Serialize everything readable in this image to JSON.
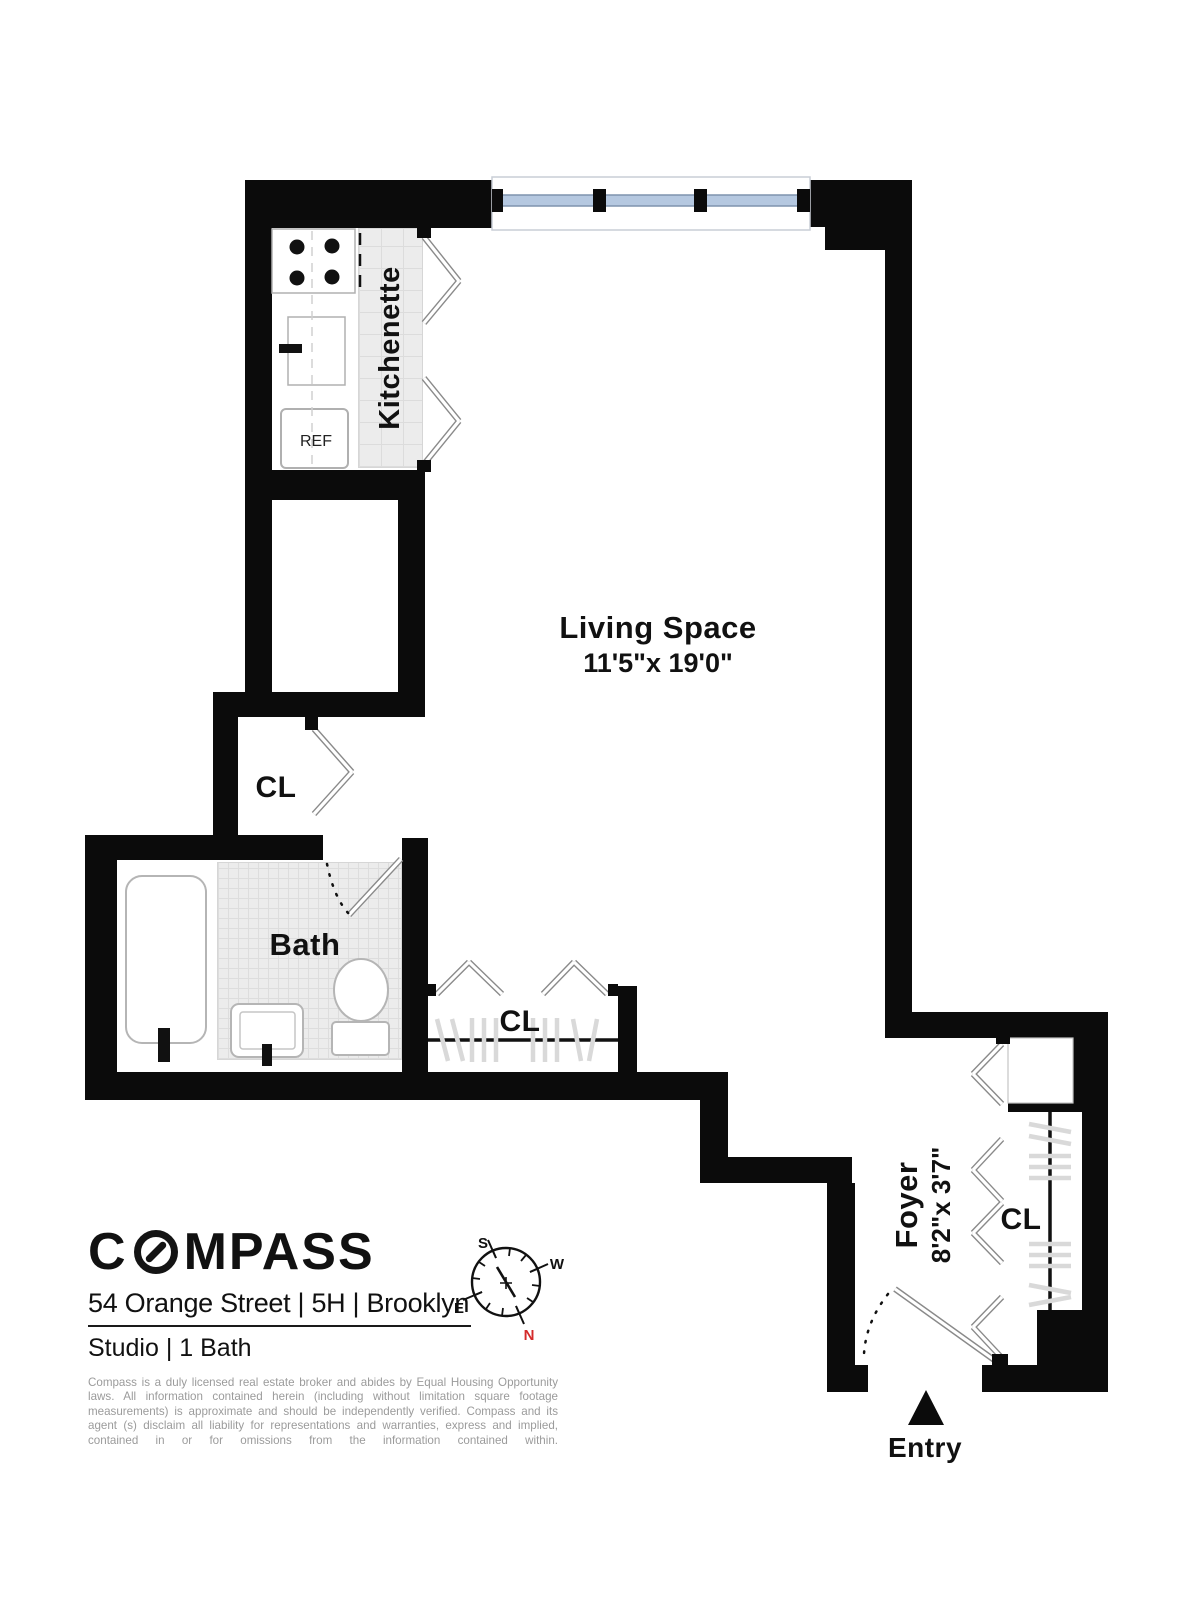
{
  "floorplan": {
    "rooms": {
      "kitchenette": {
        "label": "Kitchenette"
      },
      "living_space": {
        "label": "Living Space",
        "dimensions": "11'5\"x 19'0\""
      },
      "bath": {
        "label": "Bath"
      },
      "foyer": {
        "label": "Foyer",
        "dimensions": "8'2\"x 3'7\""
      },
      "closet_hall": {
        "label": "CL"
      },
      "closet_living": {
        "label": "CL"
      },
      "closet_foyer": {
        "label": "CL"
      },
      "entry": {
        "label": "Entry"
      },
      "refrigerator": {
        "label": "REF"
      }
    },
    "compass_rose": {
      "north": "N",
      "south": "S",
      "east": "E",
      "west": "W"
    }
  },
  "branding": {
    "logo": {
      "prefix": "C",
      "suffix": "MPASS"
    },
    "address": "54 Orange Street | 5H | Brooklyn",
    "unit_info": "Studio | 1 Bath",
    "disclaimer": "Compass is a duly licensed real estate broker and abides by Equal Housing Opportunity laws. All information contained herein (including without limitation square footage measurements) is approximate and should be independently verified. Compass and its agent (s) disclaim all liability for representations and warranties, express and implied, contained in or for omissions from the information contained within."
  },
  "colors": {
    "wall": "#0b0b0b",
    "window_glass": "#b5c8e0",
    "window_frame": "#7f93ad",
    "tile": "#ececec",
    "north_red": "#d42b2b",
    "disclaimer_gray": "#9b9b9b"
  }
}
